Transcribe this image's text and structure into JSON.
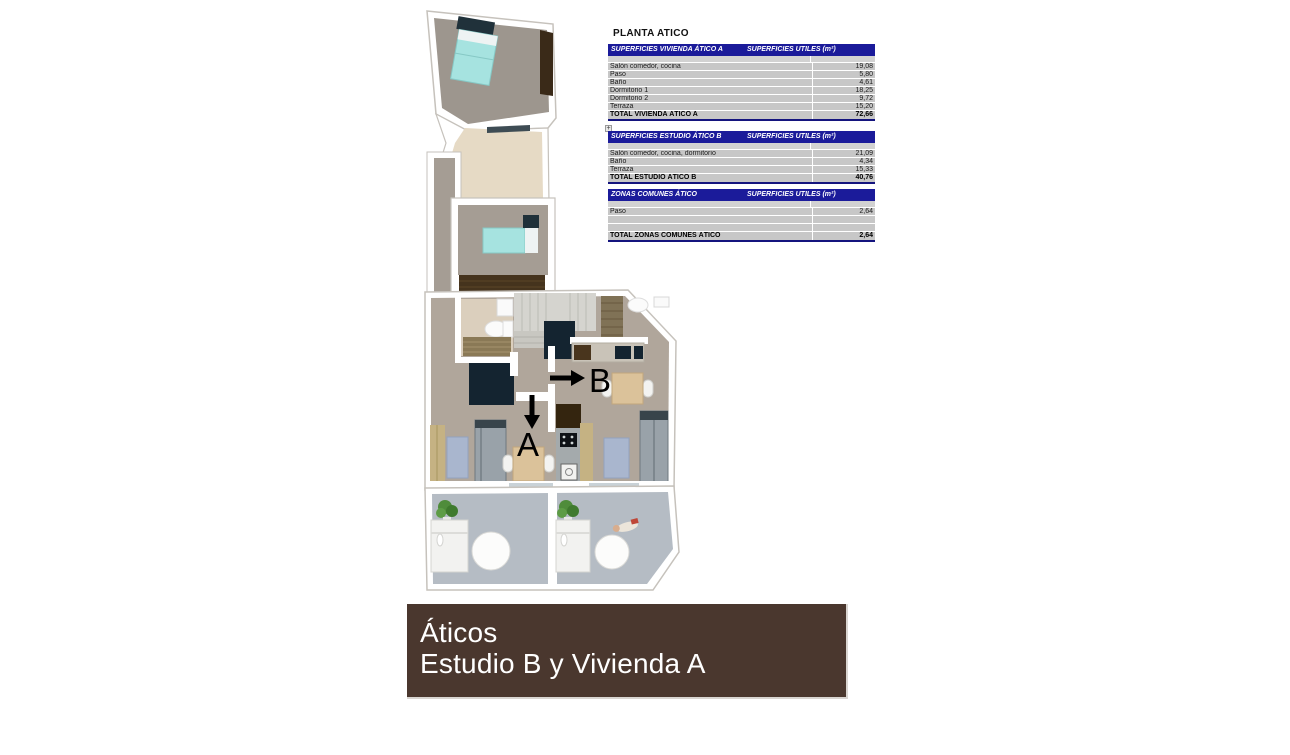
{
  "plan": {
    "label_a": "A",
    "label_b": "B"
  },
  "tables": {
    "title": "PLANTA ATICO",
    "expand_icon": "+",
    "sections": [
      {
        "title": "SUPERFICIES VIVIENDA ÁTICO A",
        "units_header": "SUPERFICIES UTILES  (m²)",
        "rows": [
          {
            "label": "Salón comedor, cocina",
            "value": "19,08"
          },
          {
            "label": "Paso",
            "value": "5,80"
          },
          {
            "label": "Baño",
            "value": "4,61"
          },
          {
            "label": "Dormitorio 1",
            "value": "18,25"
          },
          {
            "label": "Dormitorio 2",
            "value": "9,72"
          },
          {
            "label": "Terraza",
            "value": "15,20"
          }
        ],
        "total": {
          "label": "TOTAL VIVIENDA ÁTICO A",
          "value": "72,66"
        }
      },
      {
        "title": "SUPERFICIES ESTUDIO ÁTICO B",
        "units_header": "SUPERFICIES UTILES  (m²)",
        "rows": [
          {
            "label": "Salón comedor, cocina, dormitorio",
            "value": "21,09"
          },
          {
            "label": "Baño",
            "value": "4,34"
          },
          {
            "label": "Terraza",
            "value": "15,33"
          }
        ],
        "total": {
          "label": "TOTAL ESTUDIO ÁTICO B",
          "value": "40,76"
        }
      },
      {
        "title": "ZONAS COMUNES ÁTICO",
        "units_header": "SUPERFICIES UTILES  (m²)",
        "rows": [
          {
            "label": "Paso",
            "value": "2,64"
          },
          {
            "label": "",
            "value": ""
          },
          {
            "label": "",
            "value": ""
          }
        ],
        "total": {
          "label": "TOTAL ZONAS COMUNES ÁTICO",
          "value": "2,64"
        }
      }
    ]
  },
  "banner": {
    "line1": "Áticos",
    "line2": "Estudio B y Vivienda A"
  },
  "colors": {
    "table_header": "#1b1b9a",
    "table_row": "#c7c7c7",
    "banner_background": "#4a372e",
    "bed": "#a6e3e0",
    "plan_floor": "#b0a69b"
  }
}
